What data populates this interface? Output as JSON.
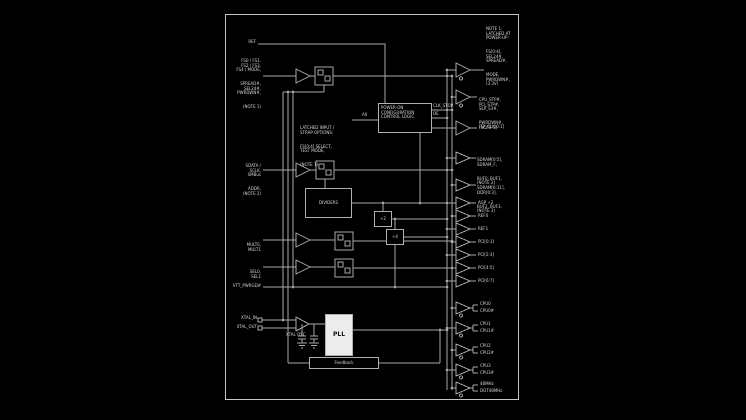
{
  "colors": {
    "background": "#000000",
    "line": "#a8a8a8",
    "text": "#d6d6d6",
    "pll_fill": "#ececec"
  },
  "labels": {
    "ref": "REF",
    "in1": [
      "FS0 / FS1,",
      "FS2 / FS3,",
      "FS4 / MODE,",
      "SPREAD#,",
      "SEL24#,",
      "PWRDWN#,",
      "(NOTE 1)"
    ],
    "in2": [
      "SDATA /",
      "SCLK,",
      "SMBus",
      "ADDR,",
      "(NOTE 2)"
    ],
    "in3": [
      "MULT0,",
      "MULT1"
    ],
    "in4": [
      "SEL0,",
      "SEL1"
    ],
    "in5": "VTT_PWRGD#",
    "xtal_in": "XTAL_IN",
    "xtal_out": "XTAL_OUT",
    "osc": "XTAL OSC",
    "a0": "A0",
    "control": [
      "POWER-ON",
      "CONFIGURATION",
      "CONTROL LOGIC"
    ],
    "control_left": [
      "LATCHED INPUT /",
      "STRAP OPTIONS:",
      "FS[0:4] SELECT,",
      "TEST MODE,",
      "(NOTE 1)"
    ],
    "ctl_out1": "CLK_STOP",
    "ctl_out2": "OE",
    "dividers": "DIVIDERS",
    "div2": "÷2",
    "div4": "÷4",
    "pll": "PLL",
    "feedback": "Feedback",
    "out_top1": [
      "NOTE 1:",
      "LATCHED AT",
      "POWER-UP:",
      "FS[0:4],",
      "SEL24#,",
      "SPREAD#,",
      "MODE,",
      "PWRDWN#,",
      "(3.3V)"
    ],
    "out_top2": [
      "CPU_STP#,",
      "PCI_STP#,",
      "SLP_S3#,",
      "PWRDWN#,",
      "(NOTE 3)"
    ],
    "out_top3": "ITP_CLK[0:1]",
    "out_mid1": [
      "SDRAM[0:5],",
      "SDRAM_F,",
      "BUF0, BUF1,",
      "(NOTE 2)"
    ],
    "out_mid2": [
      "SDRAM[6:11],",
      "DDR[0:3],",
      "BUF2, BUF3,",
      "(NOTE 2)"
    ],
    "out_singles": [
      "AGP ÷2",
      "REF0",
      "REF1",
      "PCI[0:1]",
      "PCI[2:3]",
      "PCI[4:5]",
      "PCI[6:7]"
    ],
    "out_pairs": [
      [
        "CPU0",
        "CPU0#"
      ],
      [
        "CPU1",
        "CPU1#"
      ],
      [
        "CPU2",
        "CPU2#"
      ],
      [
        "CPU3",
        "CPU3#"
      ],
      [
        "48MHz",
        "DOT48MHz"
      ]
    ]
  }
}
